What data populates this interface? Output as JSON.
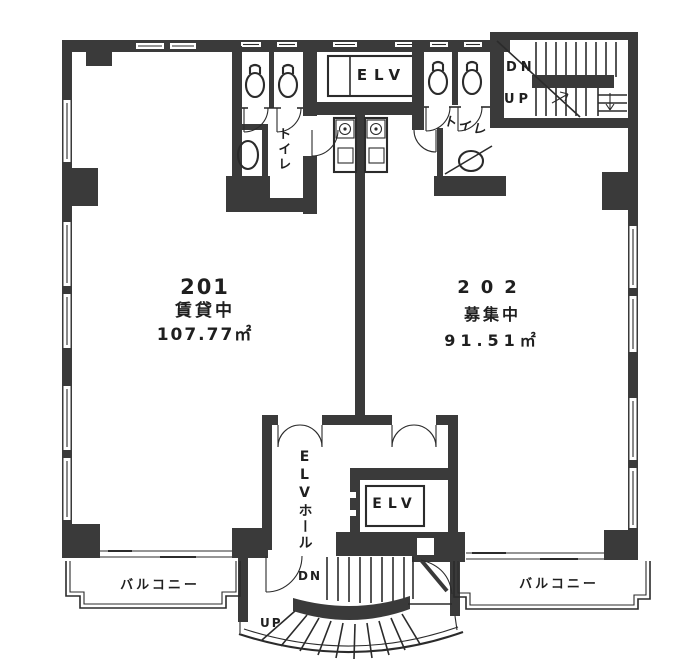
{
  "floorplan": {
    "units": {
      "u201": {
        "number": "201",
        "status": "賃貸中",
        "area": "107.77㎡"
      },
      "u202": {
        "number": "202",
        "status": "募集中",
        "area": "91.51㎡"
      }
    },
    "elevator_top_label": "ELV",
    "elevator_bottom_label": "ELV",
    "elevator_hall_label": "ELVホール",
    "toilet_left_label": "トイレ",
    "toilet_right_label": "トイレ",
    "balcony_left_label": "バルコニー",
    "balcony_right_label": "バルコニー",
    "stairs_top": {
      "down": "DN",
      "up": "UP"
    },
    "stairs_bottom": {
      "down": "DN",
      "up": "UP"
    }
  },
  "colors": {
    "wall": "#3a3a3a",
    "line": "#2b2b2b",
    "background": "#ffffff",
    "text": "#1f1f1f"
  }
}
